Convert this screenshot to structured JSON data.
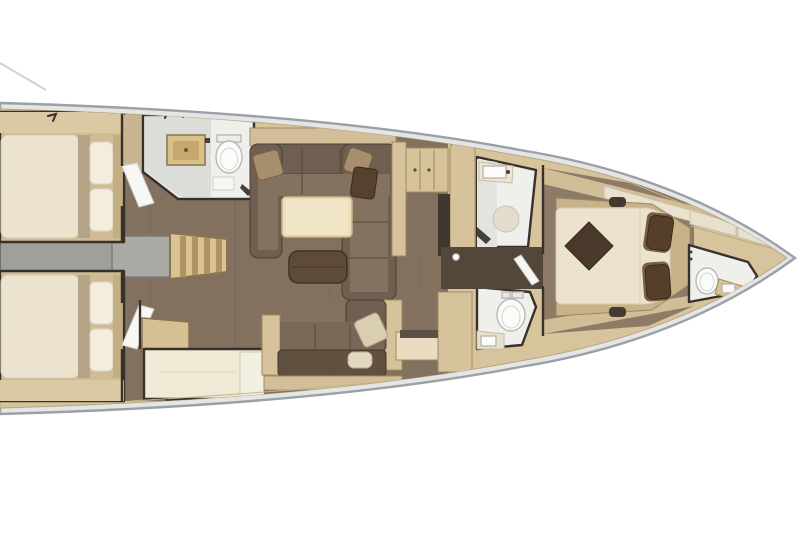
{
  "plan": {
    "type": "sailing-yacht-interior-floor-plan",
    "orientation": "bow-right",
    "visible_text": "none"
  },
  "colors": {
    "background": "#ffffff",
    "hull_outline": "#9aa0a3",
    "hull_band": "#e3e5e6",
    "deck_wood": "#d7c49d",
    "deck_seam": "#c3b28a",
    "wall": "#37312a",
    "cabin_sole": "#cfbc96",
    "shelf_wood": "#dbc9a3",
    "corridor_wood": "#c9b691",
    "mattress": "#ebe3ce",
    "mattress_runner": "#b6a487",
    "pillow_white": "#f2eddd",
    "platform_grey": "#9fa09c",
    "steps_wood": "#d9c293",
    "steps_tread": "#b1945f",
    "bath_floor": "#efefec",
    "shower_floor": "#dcddd9",
    "fixture_white": "#fbfbf9",
    "fixture_outline": "#b8b8b4",
    "vanity_wood": "#d9c089",
    "salon_floor": "#83715f",
    "sofa_dark": "#6f5f50",
    "sofa_seat": "#847260",
    "sofa_deep": "#60503f",
    "cushion_tan": "#a78f6d",
    "cushion_light": "#dcd2b8",
    "table_wood": "#eedfb8",
    "ottoman": "#5d4a3b",
    "locker_wood": "#d6c39b",
    "counter_dark": "#3f382f",
    "bench_cream": "#efe9d6",
    "owner_floor": "#8d7b68",
    "bed_platform": "#c7b289",
    "bed_throw": "#4b392b",
    "bed_pillow_dark": "#563f2a",
    "bed_pillow_mid": "#7b5f44",
    "shelf_cushion": "#e9e2cf",
    "passage_floor": "#53473a"
  },
  "legend": {
    "rooms": [
      {
        "name": "aft-cabin-port",
        "items": [
          "double-berth",
          "pillows",
          "cabin-door"
        ]
      },
      {
        "name": "aft-cabin-starboard",
        "items": [
          "double-berth",
          "pillows",
          "cabin-door"
        ]
      },
      {
        "name": "aft-heads-port",
        "items": [
          "vanity-sink",
          "toilet",
          "shower-floor"
        ]
      },
      {
        "name": "companionway",
        "items": [
          "steps",
          "engine-platform"
        ]
      },
      {
        "name": "nav-bench-starboard",
        "items": [
          "desk",
          "bench"
        ]
      },
      {
        "name": "salon",
        "items": [
          "u-sofa-port",
          "dining-table",
          "ottoman",
          "sofa-starboard",
          "throw-pillows"
        ]
      },
      {
        "name": "galley-lockers",
        "items": [
          "cabinets",
          "tall-locker",
          "counter"
        ]
      },
      {
        "name": "shower-room-port",
        "items": [
          "vanity-sink",
          "shower-tray"
        ]
      },
      {
        "name": "heads-starboard",
        "items": [
          "toilet",
          "vanity-sink"
        ]
      },
      {
        "name": "owner-cabin",
        "items": [
          "island-double-bed",
          "throw-blanket",
          "pillows",
          "side-shelves",
          "bed-platform"
        ]
      },
      {
        "name": "bow-heads",
        "items": [
          "toilet",
          "vanity-sink"
        ]
      },
      {
        "name": "bow-shelves",
        "items": [
          "shelf-panels"
        ]
      }
    ]
  }
}
